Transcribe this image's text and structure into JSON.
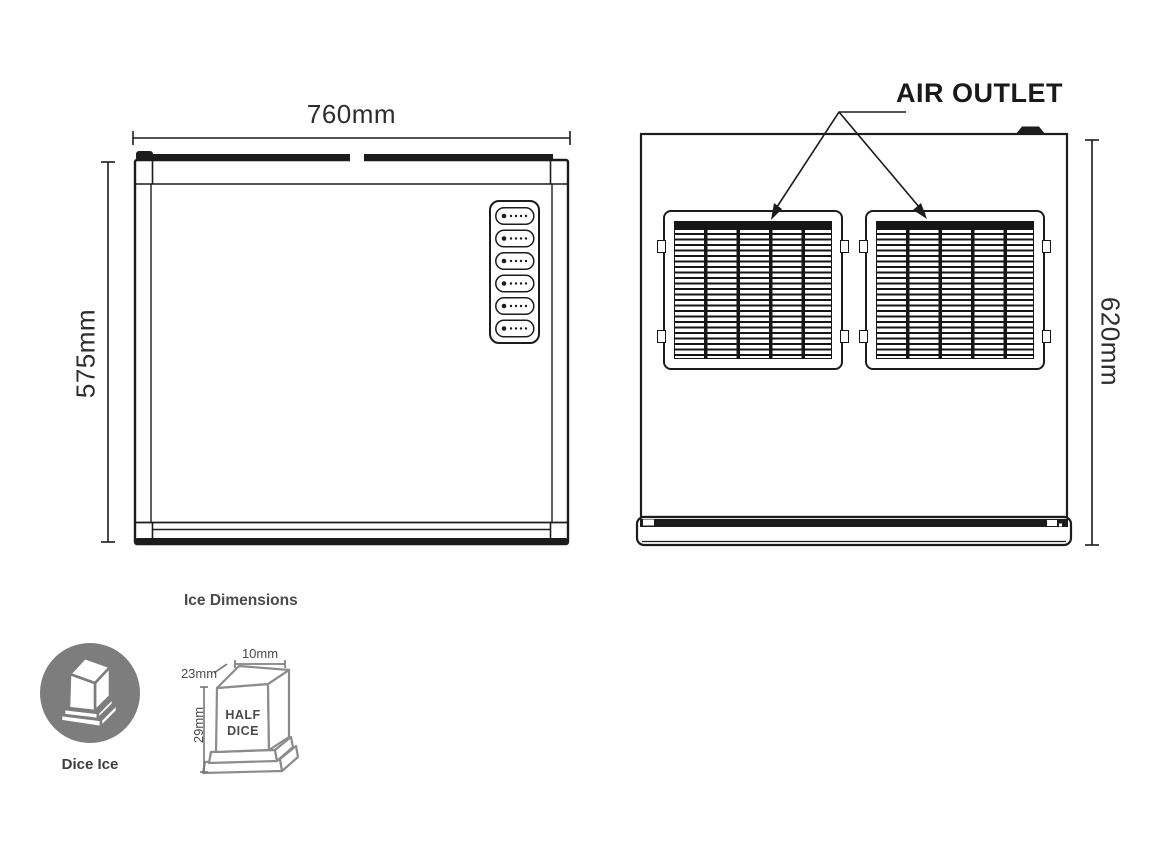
{
  "front_view": {
    "width_label": "760mm",
    "height_label": "575mm"
  },
  "back_view": {
    "air_outlet_label": "AIR OUTLET",
    "height_label": "620mm"
  },
  "ice_section": {
    "title": "Ice Dimensions",
    "dice_ice_label": "Dice Ice",
    "half_dice": {
      "label_line1": "HALF",
      "label_line2": "DICE",
      "top_width_label": "10mm",
      "depth_label": "23mm",
      "height_label": "29mm"
    }
  },
  "colors": {
    "line": "#1c1c1c",
    "icon_gray": "#7d7d7d",
    "cube_outline_gray": "#8c8c8c",
    "dimension_line_gray": "#6e6e6e",
    "dimension_text": "#2d2d2d",
    "small_label_text": "#4a4a4a"
  }
}
